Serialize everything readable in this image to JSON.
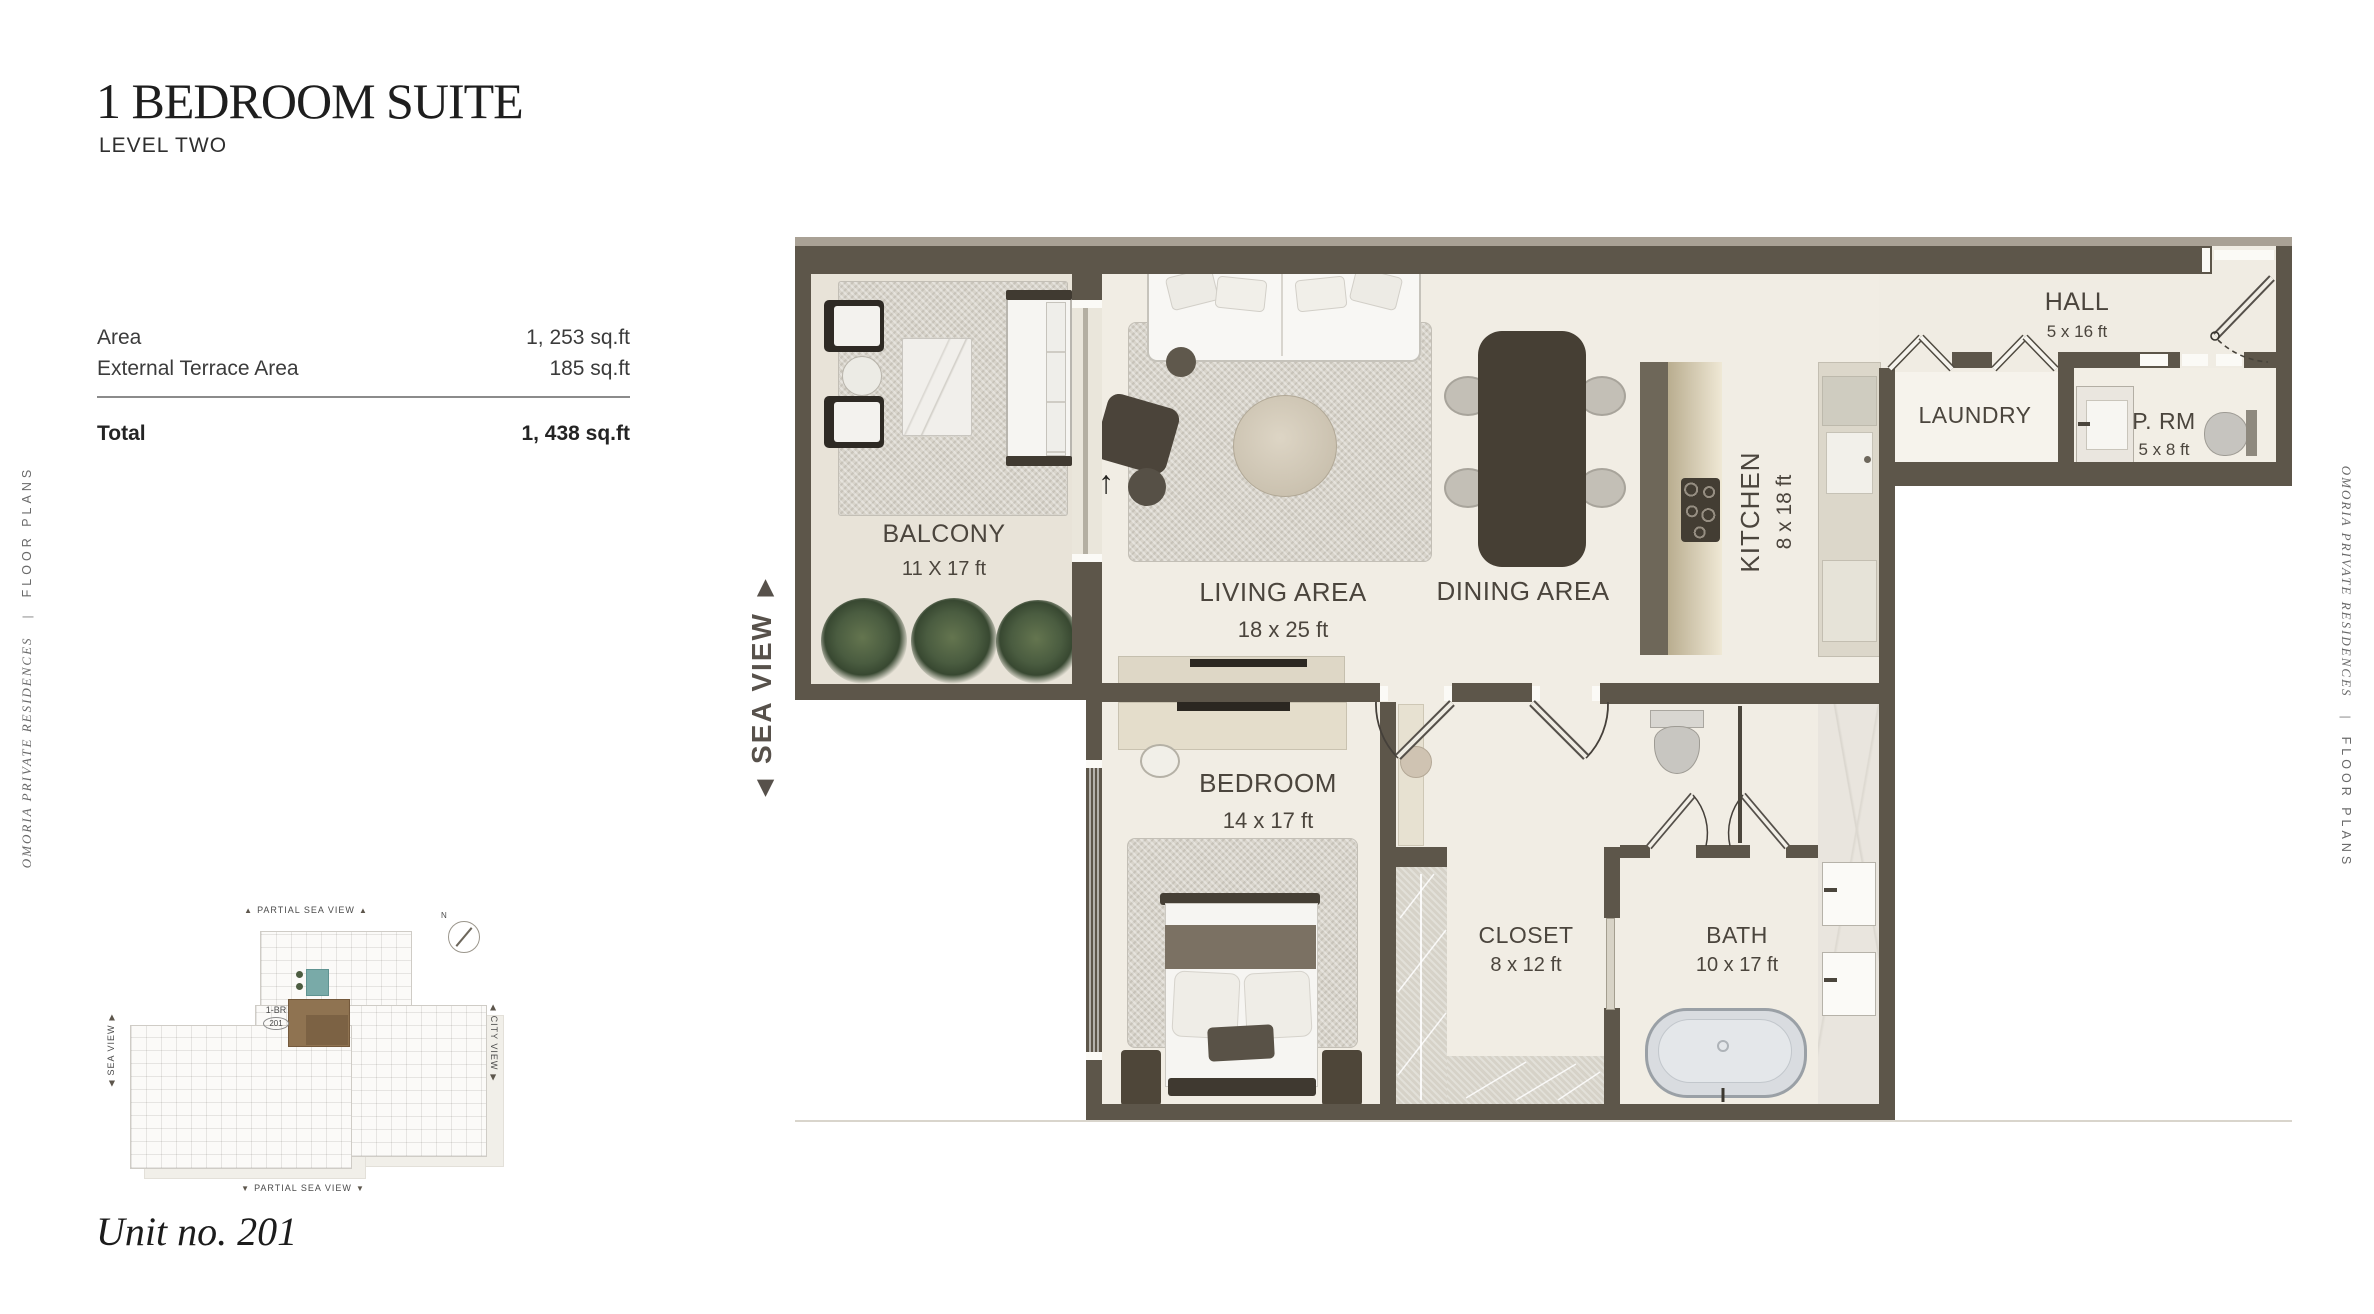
{
  "page": {
    "title": "1 BEDROOM SUITE",
    "subtitle": "LEVEL TWO"
  },
  "area_table": {
    "rows": [
      {
        "label": "Area",
        "value": "1, 253 sq.ft"
      },
      {
        "label": "External Terrace Area",
        "value": "185 sq.ft"
      }
    ],
    "total_label": "Total",
    "total_value": "1, 438 sq.ft"
  },
  "side_text": {
    "brand": "OMORIA PRIVATE RESIDENCES",
    "separator": "|",
    "section": "FLOOR PLANS"
  },
  "sea_view": {
    "label": "SEA VIEW",
    "start_arrow": "◀",
    "end_arrow": "▶"
  },
  "floorplan": {
    "entry_arrow": "↑",
    "rooms": {
      "balcony": {
        "name": "BALCONY",
        "dims": "11 X 17 ft"
      },
      "living": {
        "name": "LIVING AREA",
        "dims": "18 x 25 ft"
      },
      "dining": {
        "name": "DINING AREA"
      },
      "kitchen": {
        "name": "KITCHEN",
        "dims": "8 x 18 ft"
      },
      "hall": {
        "name": "HALL",
        "dims": "5 x 16 ft"
      },
      "laundry": {
        "name": "LAUNDRY"
      },
      "powder_room": {
        "name": "P. RM",
        "dims": "5 x 8 ft"
      },
      "bedroom": {
        "name": "BEDROOM",
        "dims": "14 x 17 ft"
      },
      "closet": {
        "name": "CLOSET",
        "dims": "8 x 12 ft"
      },
      "bath": {
        "name": "BATH",
        "dims": "10 x 17 ft"
      }
    }
  },
  "keyplan": {
    "top_label": "PARTIAL SEA VIEW",
    "bottom_label": "PARTIAL SEA VIEW",
    "left_label": "SEA VIEW",
    "right_label": "CITY VIEW",
    "unit_tag": "1-BR",
    "unit_badge": "201",
    "compass_north": "N",
    "up_triangle": "▲",
    "down_triangle": "▼",
    "side_start_arrow": "◀",
    "side_end_arrow": "▶"
  },
  "footer": {
    "unit_label": "Unit no. 201"
  },
  "colors": {
    "wall": "#5d564a",
    "floor": "#f1ede4",
    "balcony_floor": "#e8e3d8",
    "dark_furniture": "#4a4238",
    "plant_green": "#46573c",
    "marble": "#e9e5de",
    "sea_view_label": "#57514b",
    "pool_teal": "#79aaa8",
    "keyplan_unit_brown": "#8f7351"
  }
}
